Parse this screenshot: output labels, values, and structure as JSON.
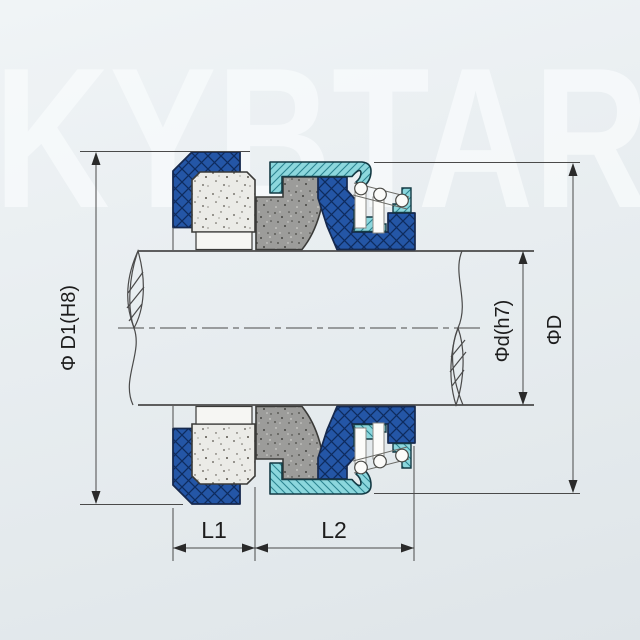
{
  "watermark": {
    "text": "KYBTAR"
  },
  "dimensions": {
    "bore": {
      "label": "Φ D1(H8)"
    },
    "shaft": {
      "label": "Φd(h7)"
    },
    "outer": {
      "label": "ΦD"
    },
    "length1": {
      "label": "L1"
    },
    "length2": {
      "label": "L2"
    }
  },
  "colors": {
    "background": "#E8EDF0",
    "watermark": "#F8FBFC",
    "elastomer_blue": "#2456A6",
    "elastomer_hatch": "#0E2B5E",
    "retainer_teal": "#8CD7DD",
    "retainer_hatch": "#2C8490",
    "seat_ceramic": "#EBEBE7",
    "face_gray": "#9C9C9A",
    "line": "#4A4A4A",
    "text": "#1C1C1C"
  }
}
